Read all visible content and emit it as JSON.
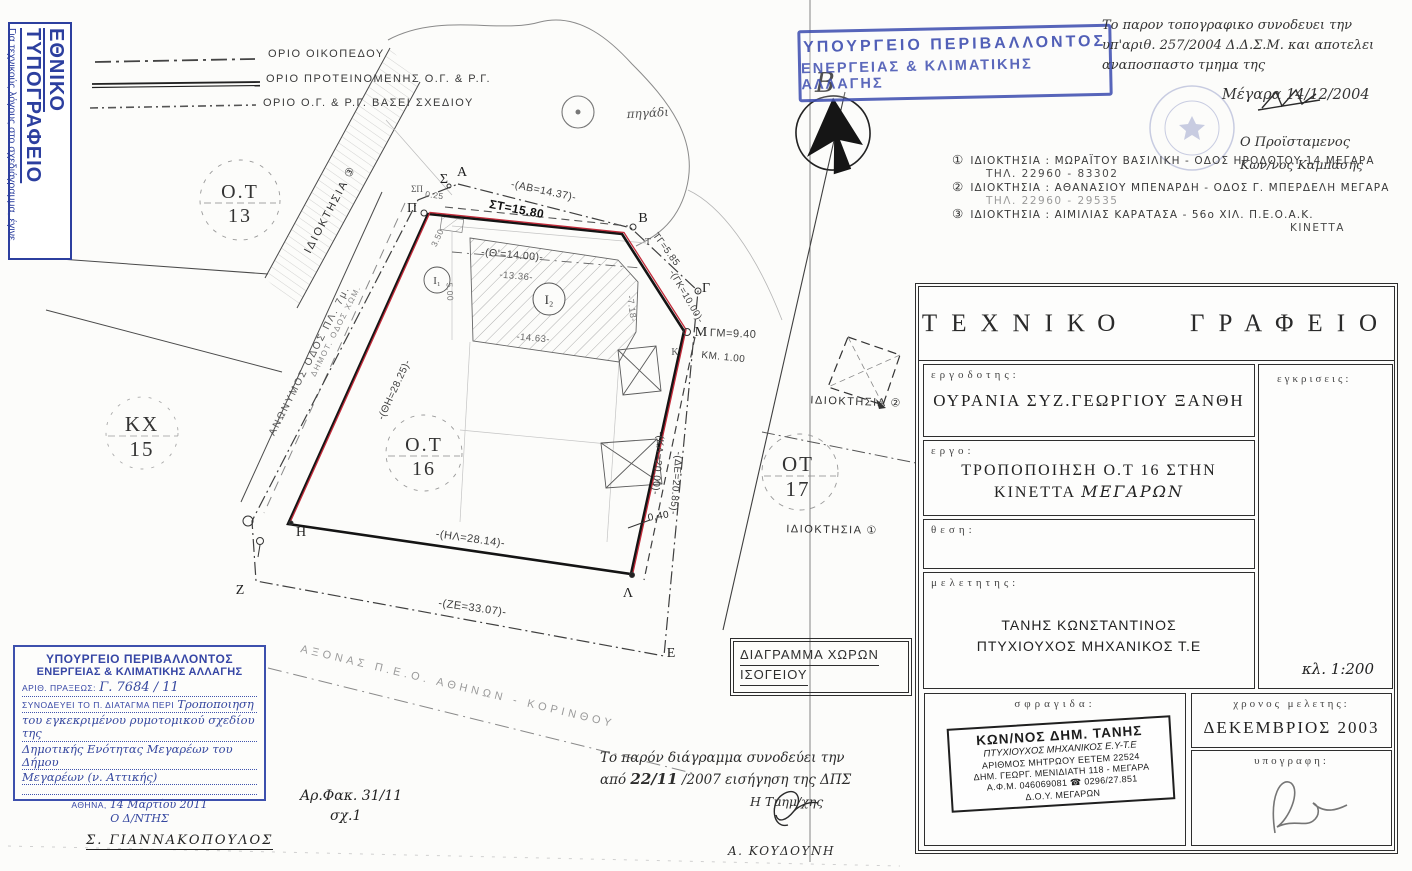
{
  "reduction_box": {
    "title": "ΕΘΝΙΚΟ ΤΥΠΟΓΡΑΦΕΙΟ",
    "note": "Για τεχνικούς λόγους στο σχεδιάγραμμα, έγινε σμίκρυνση, κατά ποσοστό ",
    "percent": "42%"
  },
  "legend": {
    "items": [
      {
        "style": "dash-dot",
        "label": "ΟΡΙΟ ΟΙΚΟΠΕΔΟΥ"
      },
      {
        "style": "solid-double",
        "label": "ΟΡΙΟ ΠΡΟΤΕΙΝΟΜΕΝΗΣ Ο.Γ. & Ρ.Γ."
      },
      {
        "style": "dashed",
        "label": "ΟΡΙΟ Ο.Γ. & Ρ.Γ. ΒΑΣΕΙ ΣΧΕΔΙΟΥ"
      }
    ]
  },
  "ministry_stamp_top": {
    "line1": "ΥΠΟΥΡΓΕΙΟ ΠΕΡΙΒΑΛΛΟΝΤΟΣ",
    "line2": "ΕΝΕΡΓΕΙΑΣ & ΚΛΙΜΑΤΙΚΗΣ ΑΛΛΑΓΗΣ"
  },
  "north": {
    "letter": "Β"
  },
  "note_top_right": {
    "line1": "Το παρον τοπογραφικο συνοδευει την",
    "line2": "υπ'αριθ. 257/2004 Δ.Δ.Σ.Μ. και αποτελει",
    "line3": "αναποσπαστο τμημα της",
    "place_date": "Μέγαρα 14/12/2004",
    "role": "Ο Προϊσταμενος",
    "name": "Κων/νος Καμπάσης"
  },
  "ownerships": [
    {
      "num": "①",
      "line": "ΙΔΙΟΚΤΗΣΙΑ : ΜΩΡΑΪΤΟΥ ΒΑΣΙΛΙΚΗ - ΟΔΟΣ ΗΡΟΔΟΤΟΥ 14 ΜΕΓΑΡΑ",
      "sub": "ΤΗΛ. 22960 - 83302"
    },
    {
      "num": "②",
      "line": "ΙΔΙΟΚΤΗΣΙΑ : ΑΘΑΝΑΣΙΟΥ ΜΠΕΝΑΡΔΗ - ΟΔΟΣ Γ. ΜΠΕΡΔΕΛΗ ΜΕΓΑΡΑ",
      "sub": "ΤΗΛ. 22960 - 29535"
    },
    {
      "num": "③",
      "line": "ΙΔΙΟΚΤΗΣΙΑ : ΑΙΜΙΛΙΑΣ ΚΑΡΑΤΑΣΑ - 56ο ΧΙΛ. Π.Ε.Ο.Α.Κ.",
      "sub": "ΚΙΝΕΤΤΑ"
    }
  ],
  "title_block": {
    "office": "ΤΕΧΝΙΚΟ   ΓΡΑΦΕΙΟ",
    "client_label": "εργοδοτης:",
    "client": "ΟΥΡΑΝΙΑ ΣΥΖ.ΓΕΩΡΓΙΟΥ ΞΑΝΘΗ",
    "project_label": "εργο:",
    "project_line1": "ΤΡΟΠΟΠΟΙΗΣΗ Ο.Τ 16 ΣΤΗΝ",
    "project_line2a": "ΚΙΝΕΤΤΑ ",
    "project_line2b": "ΜΕΓΑΡΩΝ",
    "location_label": "θεση:",
    "approvals_label": "εγκρισεις:",
    "scale": "κλ. 1:200",
    "designer_label": "μελετητης:",
    "designer_line1": "ΤΑΝΗΣ ΚΩΝΣΤΑΝΤΙΝΟΣ",
    "designer_line2": "ΠΤΥΧΙΟΥΧΟΣ ΜΗΧΑΝΙΚΟΣ Τ.Ε",
    "stamp_label": "σφραγιδα:",
    "date_label": "χρονος μελετης:",
    "date": "ΔΕΚΕΜΒΡΙΟΣ 2003",
    "signature_label": "υπογραφη:"
  },
  "engineer_stamp": {
    "l1": "ΚΩΝ/ΝΟΣ ΔΗΜ. ΤΑΝΗΣ",
    "l2": "ΠΤΥΧΙΟΥΧΟΣ ΜΗΧΑΝΙΚΟΣ Ε.Υ-Τ.Ε",
    "l3": "ΑΡΙΘΜΟΣ ΜΗΤΡΩΟΥ ΕΕΤΕΜ 22524",
    "l4": "ΔΗΜ. ΓΕΩΡΓ. ΜΕΝΙΔΙΑΤΗ 118 - ΜΕΓΑΡΑ",
    "l5": "Α.Φ.Μ. 046069081  ☎ 0296/27.851",
    "l6": "Δ.Ο.Υ. ΜΕΓΑΡΩΝ"
  },
  "diagram_box": {
    "line1": "ΔΙΑΓΡΑΜΜΑ ΧΩΡΩΝ",
    "line2": "ΙΣΟΓΕΙΟΥ"
  },
  "ministry_stamp_bottom": {
    "line1": "ΥΠΟΥΡΓΕΙΟ ΠΕΡΙΒΑΛΛΟΝΤΟΣ",
    "line2": "ΕΝΕΡΓΕΙΑΣ & ΚΛΙΜΑΤΙΚΗΣ ΑΛΛΑΓΗΣ",
    "act_label": "ΑΡΙΘ. ΠΡΑΞΕΩΣ:",
    "act_value": "Γ. 7684 / 11",
    "decree_label": "ΣΥΝΟΔΕΥΕΙ ΤΟ Π. ΔΙΑΤΑΓΜΑ ΠΕΡΙ",
    "hand1": "Τροποποιηση",
    "hand2": "του εγκεκριμένου ρυμοτομικού σχεδίου της",
    "hand3": "Δημοτικής Ενότητας Μεγαρέων του Δήμου",
    "hand4": "Μεγαρέων (ν. Αττικής)",
    "city_label": "ΑΘΗΝΑ,",
    "city_date": "14 Μαρτίου 2011",
    "director": "Ο Δ/ΝΤΗΣ"
  },
  "signed_name_bottom_left": "Σ. ΓΙΑΝΝΑΚΟΠΟΥΛΟΣ",
  "file_ref": {
    "line1": "Αρ.Φακ. 31/11",
    "line2": "σχ.1"
  },
  "note_bottom": {
    "line1": "Το παρόν διάγραμμα συνοδεύει την",
    "line2a": "από ",
    "line2b": "22/11",
    "line2c": " /2007  εισήγηση της ΔΠΣ",
    "role": "Η Τμημ/χης",
    "name": "Α. ΚΟΥΔΟΥΝΗ"
  },
  "plan": {
    "well": "πηγάδι",
    "road_anonymous": "ΑΝΩΝΥΜΟΣ ΟΔΟΣ ΠΛ. 7μ.",
    "road_dirt": "ΔΗΜΟΤ. ΟΔΟΣ ΧΩΜ.",
    "axis_peo": "ΑΞΟΝΑΣ   Π.Ε.Ο.  ΑΘΗΝΩΝ - ΚΟΡΙΝΘΟΥ",
    "blocks": {
      "ot13a": "Ο.Τ",
      "ot13b": "13",
      "kxa": "ΚΧ",
      "kxb": "15",
      "ot16a": "Ο.Τ",
      "ot16b": "16",
      "ot17a": "ΟΤ",
      "ot17b": "17"
    },
    "own_tags": {
      "t1": "ΙΔΙΟΚΤΗΣΙΑ ①",
      "t2": "ΙΔΙΟΚΤΗΣΙΑ ②",
      "t3": "ΙΔΙΟΚΤΗΣΙΑ ③"
    },
    "points": {
      "sigma": "Σ",
      "alpha": "Α",
      "pi": "Π",
      "beta": "Β",
      "gamma": "Γ",
      "tau": "Τ",
      "mu": "Μ",
      "kappa": "Κ",
      "lambda": "Λ",
      "epsilon": "Ε",
      "zeta": "Ζ",
      "eta": "Η",
      "sp": "ΣΠ",
      "i1": "Ι₁",
      "i2": "Ι₂"
    },
    "meas": {
      "ab": "-(ΑΒ=14.37)-",
      "st": "ΣΤ=15.80",
      "th14": "-(Θ'=14.00)-",
      "m1336": "-13.36-",
      "tg": "ΤΓ=5.85",
      "gk": "-(ΓΚ=10.00)-",
      "gm": "ΓΜ=9.40",
      "km": "ΚΜ. 1.00",
      "kl": "-(ΚΛ=20.00)-",
      "de": "-(ΔΕ=20.85)-",
      "hl": "-(ΗΛ=28.14)-",
      "ze": "-(ΖΕ=33.07)-",
      "thh": "-(ΘΗ=28.25)-",
      "m1463": "-14.63-",
      "m718": "-7.18-",
      "m350": "3.50",
      "m500": "5.00",
      "m040": "0,40",
      "m025": "0.25"
    }
  }
}
